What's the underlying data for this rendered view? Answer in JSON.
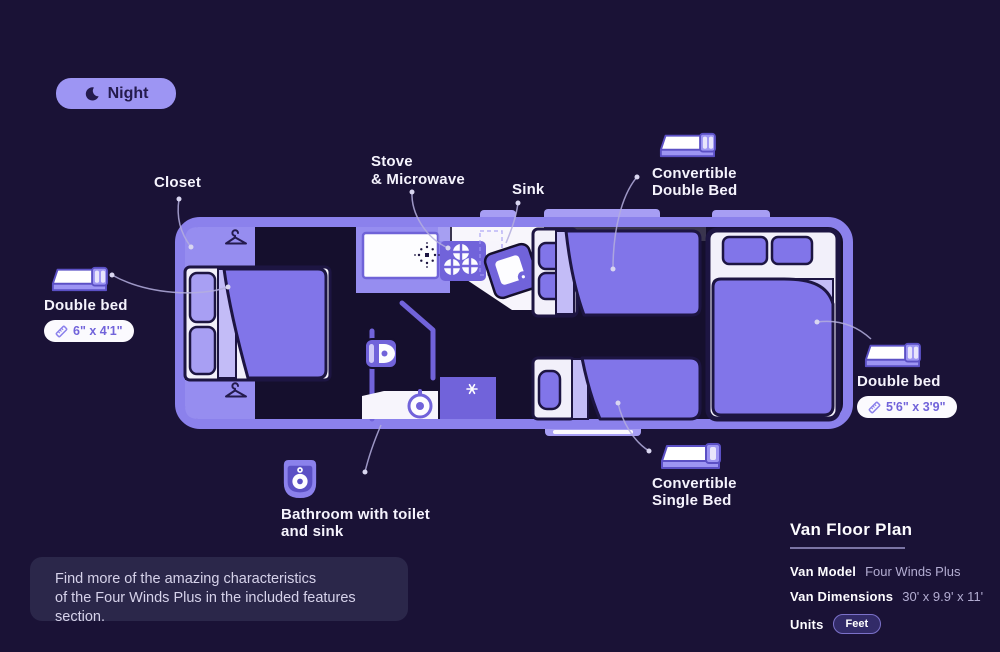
{
  "night_toggle": {
    "label": "Night"
  },
  "floorplan": {
    "callouts": {
      "closet": "Closet",
      "stove": {
        "line1": "Stove",
        "line2": "& Microwave"
      },
      "sink": "Sink",
      "convertible_double": {
        "line1": "Convertible",
        "line2": "Double Bed"
      },
      "convertible_single": {
        "line1": "Convertible",
        "line2": "Single Bed"
      },
      "bathroom": {
        "line1": "Bathroom with toilet",
        "line2": "and sink"
      },
      "front_double_bed": {
        "label": "Double bed",
        "dimensions": "6\" x 4'1\""
      },
      "rear_double_bed": {
        "label": "Double bed",
        "dimensions": "5'6\" x 3'9\""
      }
    }
  },
  "note": {
    "line1": "Find more of the amazing characteristics",
    "line2": "of the Four Winds Plus in the included features section."
  },
  "panel": {
    "title": "Van Floor Plan",
    "rows": [
      {
        "label": "Van Model",
        "value": "Four Winds Plus"
      },
      {
        "label": "Van Dimensions",
        "value": "30' x 9.9' x 11'"
      },
      {
        "label": "Units",
        "value": "Feet"
      }
    ]
  },
  "icons": {
    "moon-icon": "crescent moon",
    "hanger-icon": "clothes hanger",
    "ruler-icon": "diagonal ruler",
    "bed-icon": "3d mattress with pillows",
    "toilet-icon": "toilet badge",
    "microwave-sparkle-icon": "radiating dots",
    "snowflake-icon": "fan / vent asterisk"
  },
  "colors": {
    "background": "#1a1236",
    "accent_light": "#9d95f3",
    "van_border": "#8b81ec",
    "bed_purple": "#8175e9",
    "deep_purple": "#7163da",
    "text": "#f5f3fd"
  }
}
